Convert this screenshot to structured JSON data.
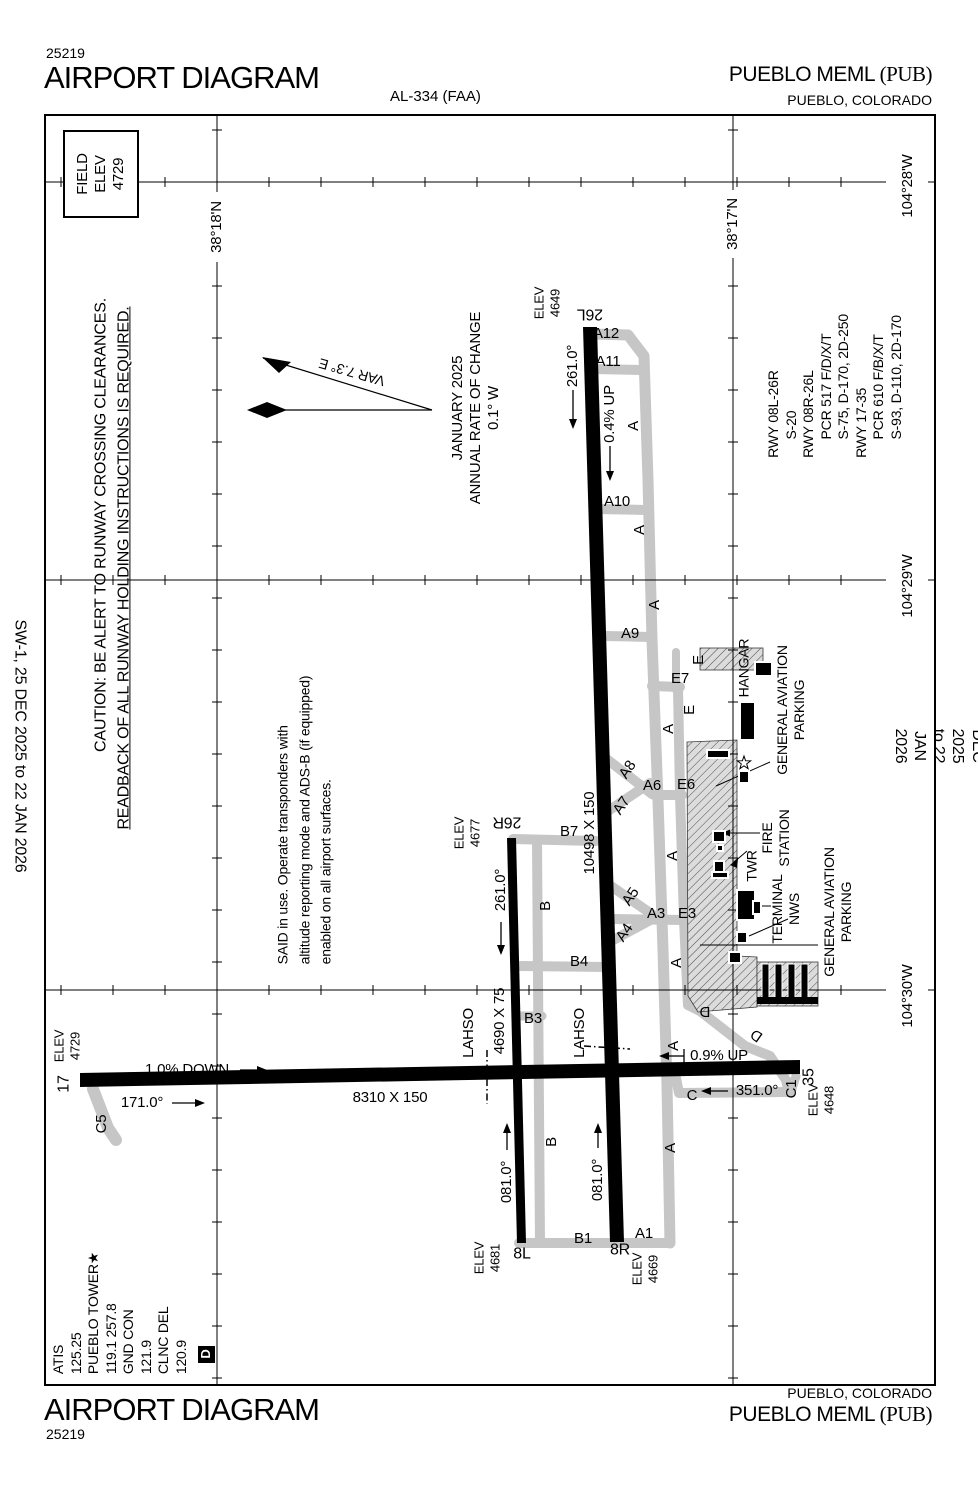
{
  "header": {
    "chart_number": "25219",
    "title": "AIRPORT DIAGRAM",
    "chart_id": "AL-334 (FAA)",
    "airport_name": "PUEBLO MEML ",
    "airport_ident": "(PUB)",
    "airport_city": "PUEBLO, COLORADO"
  },
  "footer": {
    "title": "AIRPORT DIAGRAM",
    "chart_number": "25219",
    "airport_name": "PUEBLO MEML ",
    "airport_ident": "(PUB)",
    "airport_city": "PUEBLO, COLORADO"
  },
  "edge_note": "SW-1, 25 DEC 2025 to 22 JAN 2026",
  "field_elev_box": "FIELD\nELEV\n4729",
  "caution": {
    "line1": "CAUTION: BE ALERT TO RUNWAY CROSSING CLEARANCES.",
    "line2": "READBACK OF ALL RUNWAY HOLDING INSTRUCTIONS IS REQUIRED."
  },
  "said_note": "SAID in use.  Operate transponders with\naltitude reporting mode and ADS-B (if equipped)\nenabled on all airport surfaces.",
  "magnetic_variation": {
    "var_label": "VAR 7.3° E",
    "annual_note": "JANUARY 2025\nANNUAL RATE OF CHANGE\n0.1° W"
  },
  "runway_declared_data": "RWY 08L-26R\n     S-20\nRWY 08R-26L\n     PCR 517 F/D/X/T\n     S-75, D-170, 2D-250\nRWY 17-35\n     PCR 610 F/B/X/T\n     S-93, D-110, 2D-170",
  "comms": "ATIS\n125.25\nPUEBLO TOWER★\n119.1 257.8\nGND CON\n121.9\nCLNC DEL\n120.9",
  "datis_symbol": "D",
  "graticule": {
    "lat18": "38°18'N",
    "lat17": "38°17'N",
    "lon28": "104°28'W",
    "lon29": "104°29'W",
    "lon30": "104°30'W"
  },
  "airfield": {
    "runway_17_35": {
      "dimensions": "8310 X 150",
      "end_17": "17",
      "end_35": "35",
      "elev_17": "ELEV\n4729",
      "elev_35": "ELEV\n4648",
      "heading_17": "171.0°",
      "heading_35": "351.0°",
      "slope_west": "1.0% DOWN",
      "slope_east": "0.9% UP"
    },
    "runway_08r_26l": {
      "dimensions": "10498 X 150",
      "end_26l": "26L",
      "end_8r": "8R",
      "elev_26l": "ELEV\n4649",
      "elev_8r": "ELEV\n4669",
      "heading_26l": "261.0°",
      "heading_8r": "081.0°",
      "slope": "0.4% UP"
    },
    "runway_08l_26r": {
      "dimensions": "4690 X 75",
      "end_26r": "26R",
      "end_8l": "8L",
      "elev_26r": "ELEV\n4677",
      "elev_8l": "ELEV\n4681",
      "heading_26r": "261.0°",
      "heading_8l": "081.0°"
    },
    "lahso_label": "LAHSO",
    "taxiways": {
      "a": "A",
      "b": "B",
      "c": "C",
      "d": "D",
      "e": "E",
      "a1": "A1",
      "a3": "A3",
      "a4": "A4",
      "a5": "A5",
      "a6": "A6",
      "a7": "A7",
      "a8": "A8",
      "a9": "A9",
      "a10": "A10",
      "a11": "A11",
      "a12": "A12",
      "b1": "B1",
      "b3": "B3",
      "b4": "B4",
      "b7": "B7",
      "c1": "C1",
      "c5": "C5",
      "e3": "E3",
      "e6": "E6",
      "e7": "E7"
    },
    "facilities": {
      "hangar": "HANGAR",
      "general_aviation_parking": "GENERAL AVIATION\nPARKING",
      "fire_station": "FIRE\nSTATION",
      "tower": "TWR",
      "terminal_nws": "TERMINAL\nNWS"
    }
  },
  "colors": {
    "runway": "#000000",
    "taxiway": "#c6c6c6",
    "apron_fill": "#dcdcdc",
    "hatch_line": "#3a3a3a",
    "background": "#ffffff",
    "ink": "#000000"
  }
}
